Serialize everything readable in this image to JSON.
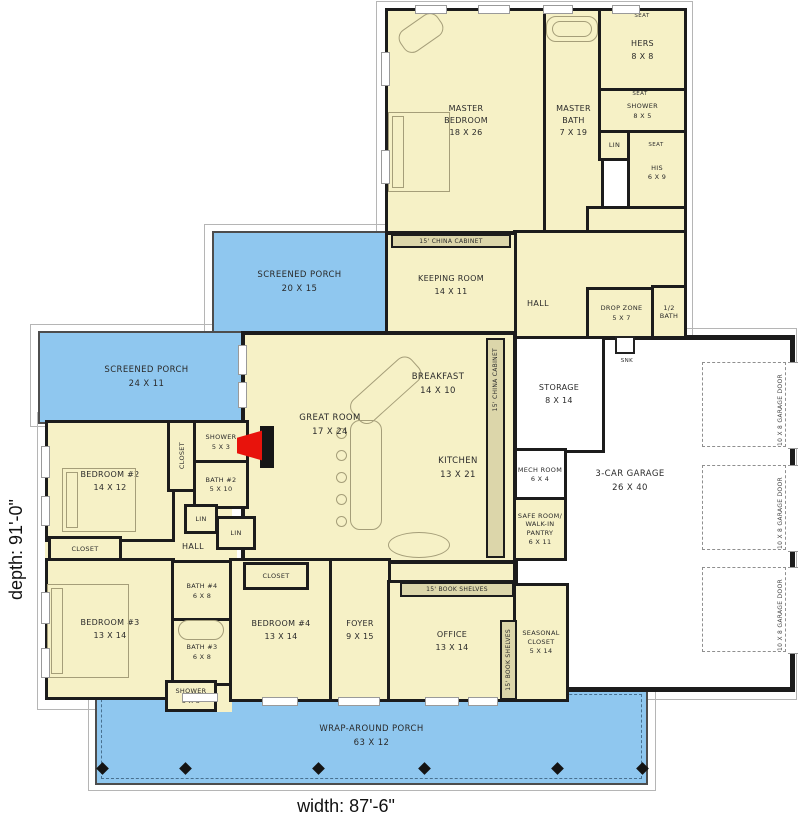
{
  "plan": {
    "width_label": "width: 87'-6\"",
    "depth_label": "depth: 91'-0\""
  },
  "labels": {
    "hall": "HALL",
    "closet": "CLOSET",
    "lin": "LIN",
    "seat": "SEAT",
    "snk": "SNK",
    "china_cabinet": "15' CHINA CABINET",
    "book_shelves": "15' BOOK SHELVES",
    "garage_door": "10 X 8 GARAGE DOOR"
  },
  "rooms": {
    "master_bedroom": {
      "name": "MASTER BEDROOM",
      "size": "18 X 26"
    },
    "master_bath": {
      "name": "MASTER BATH",
      "size": "7 X 19"
    },
    "hers": {
      "name": "HERS",
      "size": "8 X 8"
    },
    "his": {
      "name": "HIS",
      "size": "6 X 9"
    },
    "shower_master": {
      "name": "SHOWER",
      "size": "8 X 5"
    },
    "utility": {
      "name": "UTILITY",
      "size": "15 X 8"
    },
    "drop_zone": {
      "name": "DROP ZONE",
      "size": "5 X 7"
    },
    "half_bath": {
      "name": "1/2 BATH"
    },
    "keeping_room": {
      "name": "KEEPING ROOM",
      "size": "14 X 11"
    },
    "screened_porch_upper": {
      "name": "SCREENED PORCH",
      "size": "20 X 15"
    },
    "screened_porch_lower": {
      "name": "SCREENED PORCH",
      "size": "24 X 11"
    },
    "great_room": {
      "name": "GREAT ROOM",
      "size": "17 X 24"
    },
    "breakfast": {
      "name": "BREAKFAST",
      "size": "14 X 10"
    },
    "kitchen": {
      "name": "KITCHEN",
      "size": "13 X 21"
    },
    "storage": {
      "name": "STORAGE",
      "size": "8 X 14"
    },
    "garage": {
      "name": "3-CAR GARAGE",
      "size": "26 X 40"
    },
    "mech_room": {
      "name": "MECH ROOM",
      "size": "6 X 4"
    },
    "safe_room": {
      "name": "SAFE ROOM/ WALK-IN PANTRY",
      "size": "6 X 11"
    },
    "bedroom_2": {
      "name": "BEDROOM #2",
      "size": "14 X 12"
    },
    "bath_2": {
      "name": "BATH #2",
      "size": "5 X 10"
    },
    "shower_small": {
      "name": "SHOWER",
      "size": "5 X 3"
    },
    "bedroom_3": {
      "name": "BEDROOM #3",
      "size": "13 X 14"
    },
    "bedroom_4": {
      "name": "BEDROOM #4",
      "size": "13 X 14"
    },
    "bath_3": {
      "name": "BATH #3",
      "size": "6 X 8"
    },
    "bath_4": {
      "name": "BATH #4",
      "size": "6 X 8"
    },
    "foyer": {
      "name": "FOYER",
      "size": "9 X 15"
    },
    "office": {
      "name": "OFFICE",
      "size": "13 X 14"
    },
    "seasonal_closet": {
      "name": "SEASONAL CLOSET",
      "size": "5 X 14"
    },
    "wrap_porch": {
      "name": "WRAP-AROUND PORCH",
      "size": "63 X 12"
    }
  },
  "colors": {
    "room_fill": "#f6f1c6",
    "porch_fill": "#8fc7ef",
    "cabinet_fill": "#dcd6aa",
    "wall": "#1c1c1c",
    "garage_fill": "#ffffff",
    "fireplace": "#e8130c"
  }
}
